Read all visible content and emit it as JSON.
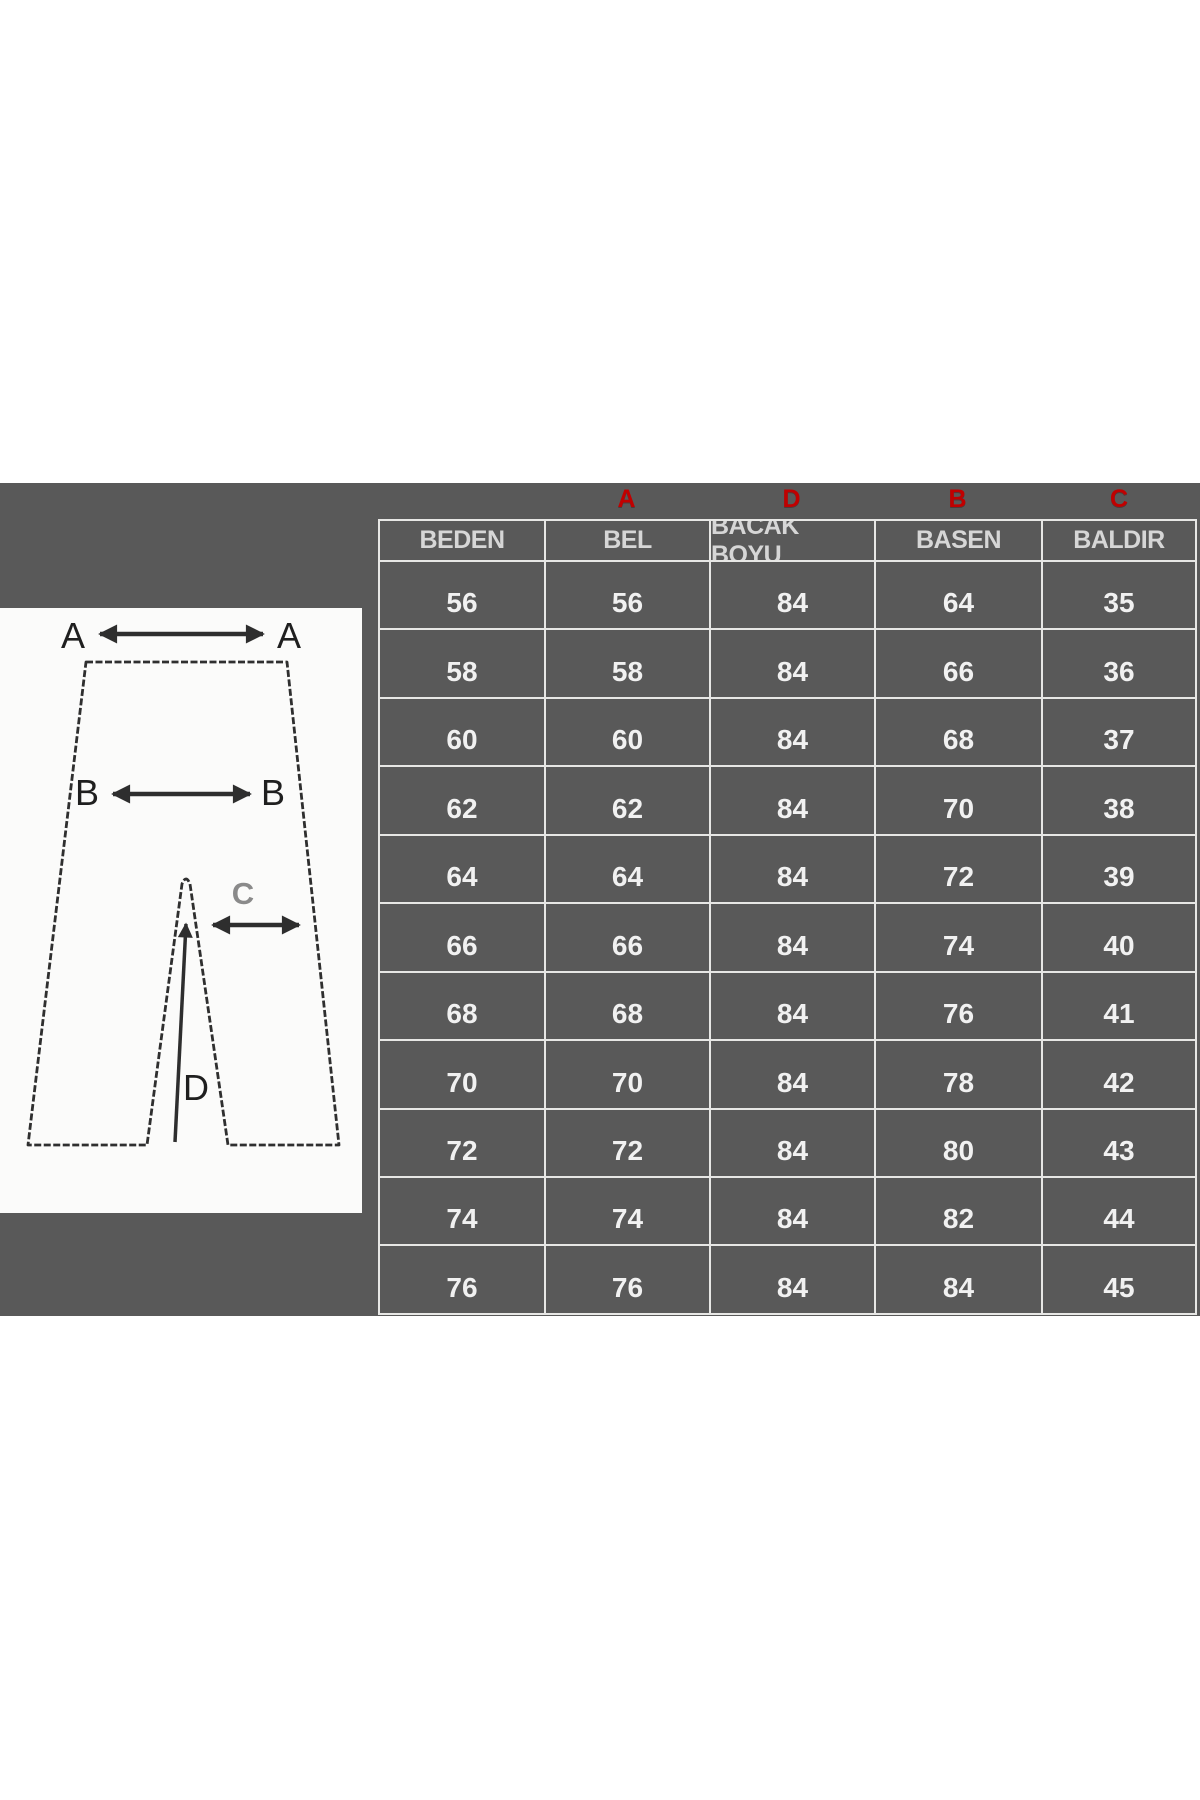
{
  "page": {
    "background": "#ffffff"
  },
  "band": {
    "background": "#595959"
  },
  "table": {
    "border_color": "#e7e7e5",
    "cell_color": "#595959",
    "header_text_color": "#d6d6d6",
    "value_text_color": "#f1f1f1",
    "marker_color": "#c00000",
    "column_markers": [
      "",
      "A",
      "D",
      "B",
      "C"
    ],
    "columns": [
      "BEDEN",
      "BEL",
      "BACAK BOYU",
      "BASEN",
      "BALDIR"
    ],
    "rows": [
      [
        "56",
        "56",
        "84",
        "64",
        "35"
      ],
      [
        "58",
        "58",
        "84",
        "66",
        "36"
      ],
      [
        "60",
        "60",
        "84",
        "68",
        "37"
      ],
      [
        "62",
        "62",
        "84",
        "70",
        "38"
      ],
      [
        "64",
        "64",
        "84",
        "72",
        "39"
      ],
      [
        "66",
        "66",
        "84",
        "74",
        "40"
      ],
      [
        "68",
        "68",
        "84",
        "76",
        "41"
      ],
      [
        "70",
        "70",
        "84",
        "78",
        "42"
      ],
      [
        "72",
        "72",
        "84",
        "80",
        "43"
      ],
      [
        "74",
        "74",
        "84",
        "82",
        "44"
      ],
      [
        "76",
        "76",
        "84",
        "84",
        "45"
      ]
    ]
  },
  "diagram": {
    "labels": {
      "a_left": "A",
      "a_right": "A",
      "b_left": "B",
      "b_right": "B",
      "c": "C",
      "d": "D"
    }
  }
}
